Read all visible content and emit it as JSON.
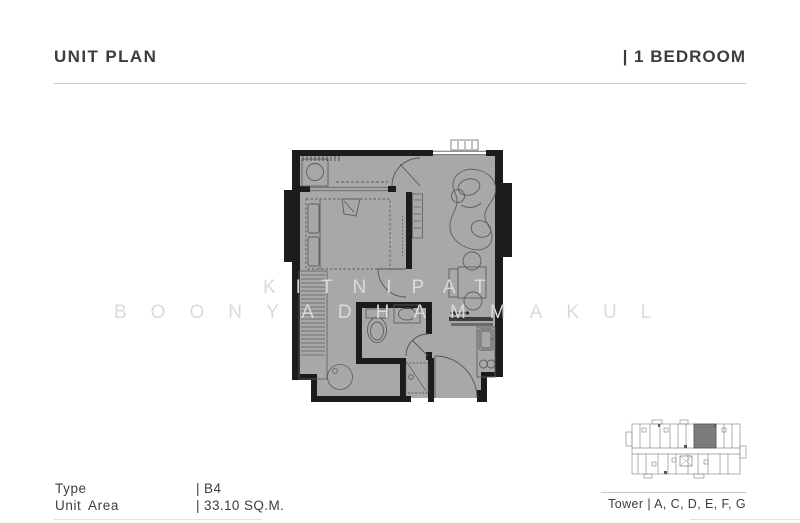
{
  "header": {
    "title": "UNIT PLAN",
    "unit_type": "| 1 BEDROOM"
  },
  "specs": {
    "type_label": "Type",
    "type_value": "| B4",
    "area_label": "Unit Area",
    "area_value": "| 33.10 SQ.M."
  },
  "key_plan": {
    "tower_label": "Tower | A, C, D, E, F, G",
    "highlighted_unit": "B4 unit position, top right of floor plate"
  },
  "watermark": {
    "line1": "KITNIPAT",
    "line2": "BOONYADHAMMAKUL"
  },
  "floor_plan": {
    "rooms": [
      "balcony",
      "bedroom",
      "living-dining",
      "bathroom",
      "kitchen",
      "entrance"
    ],
    "colors": {
      "floor": "#a8a8a8",
      "walls": "#1c1c1c",
      "furniture_line": "#646464",
      "watermark": "#dadada",
      "text": "#3d3d3d",
      "divider": "#c9c9c9",
      "keyplan_highlight": "#7c7c7c"
    }
  }
}
